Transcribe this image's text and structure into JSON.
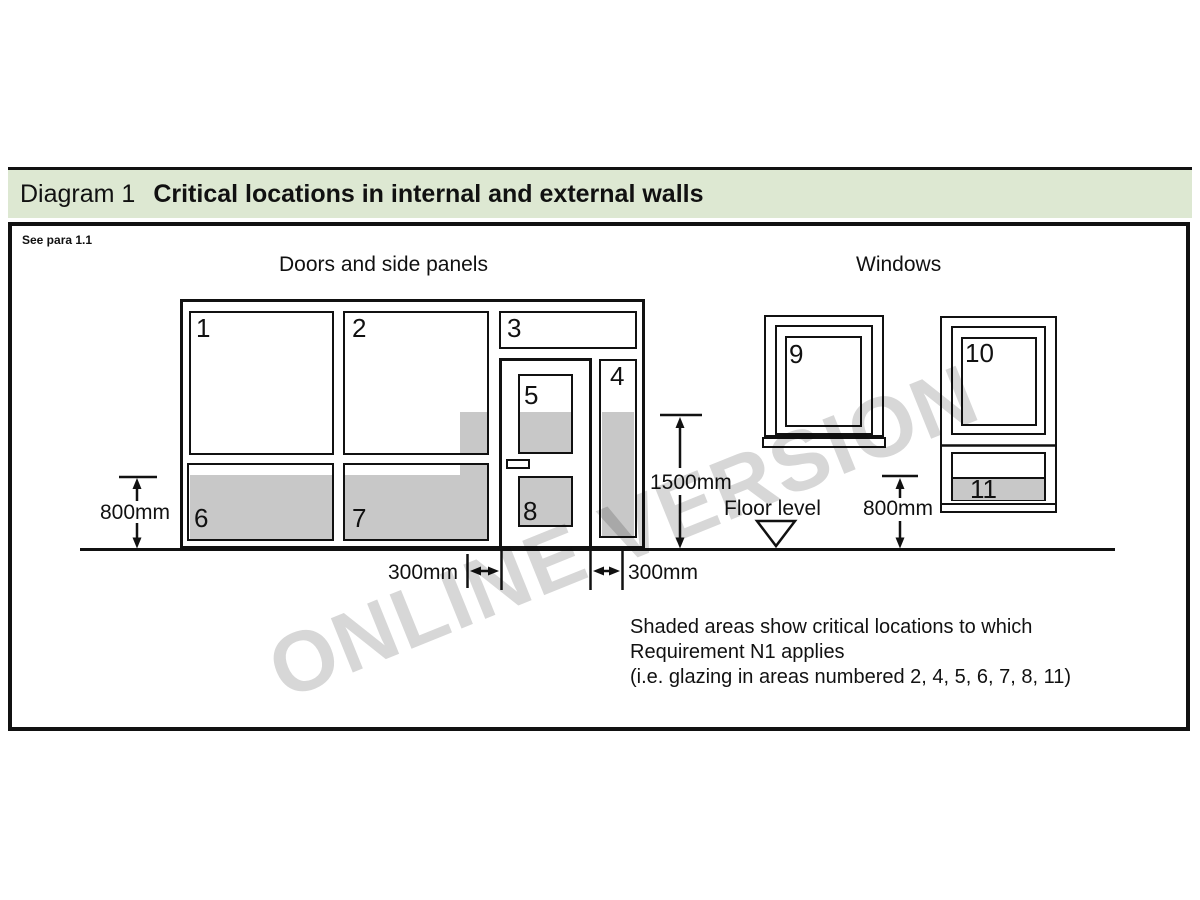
{
  "header": {
    "label": "Diagram 1",
    "title": "Critical locations in internal and external walls"
  },
  "diagram": {
    "see_para": "See para 1.1",
    "sections": {
      "doors": "Doors and side panels",
      "windows": "Windows"
    },
    "panels": [
      {
        "label": "1",
        "shaded": false
      },
      {
        "label": "2",
        "shaded": true
      },
      {
        "label": "3",
        "shaded": false
      },
      {
        "label": "4",
        "shaded": true
      },
      {
        "label": "5",
        "shaded": true
      },
      {
        "label": "6",
        "shaded": true
      },
      {
        "label": "7",
        "shaded": true
      },
      {
        "label": "8",
        "shaded": true
      },
      {
        "label": "9",
        "shaded": false
      },
      {
        "label": "10",
        "shaded": false
      },
      {
        "label": "11",
        "shaded": true
      }
    ],
    "dimensions": {
      "left_800": "800mm",
      "center_1500": "1500mm",
      "right_800": "800mm",
      "left_300": "300mm",
      "right_300": "300mm"
    },
    "floor_level": "Floor level",
    "note_line1": "Shaded areas show critical locations to which",
    "note_line2": "Requirement N1 applies",
    "note_line3": "(i.e. glazing in areas numbered 2, 4, 5, 6, 7, 8, 11)",
    "watermark": "ONLINE VERSION",
    "colors": {
      "header_bg": "#dde8d2",
      "shade_gray": "#c8c8c8",
      "line": "#111111",
      "watermark_gray": "#d7d7d7"
    }
  }
}
